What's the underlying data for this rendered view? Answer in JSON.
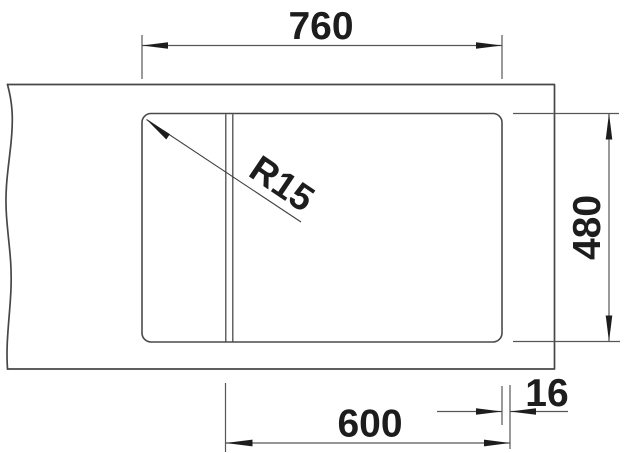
{
  "drawing": {
    "labels": {
      "top_width": "760",
      "right_height": "480",
      "bottom_width": "600",
      "right_offset": "16",
      "corner_radius": "R15"
    },
    "colors": {
      "background": "#ffffff",
      "outline": "#474747",
      "dimension_lines": "#565656",
      "text_and_arrows": "#1d1d1d"
    }
  }
}
